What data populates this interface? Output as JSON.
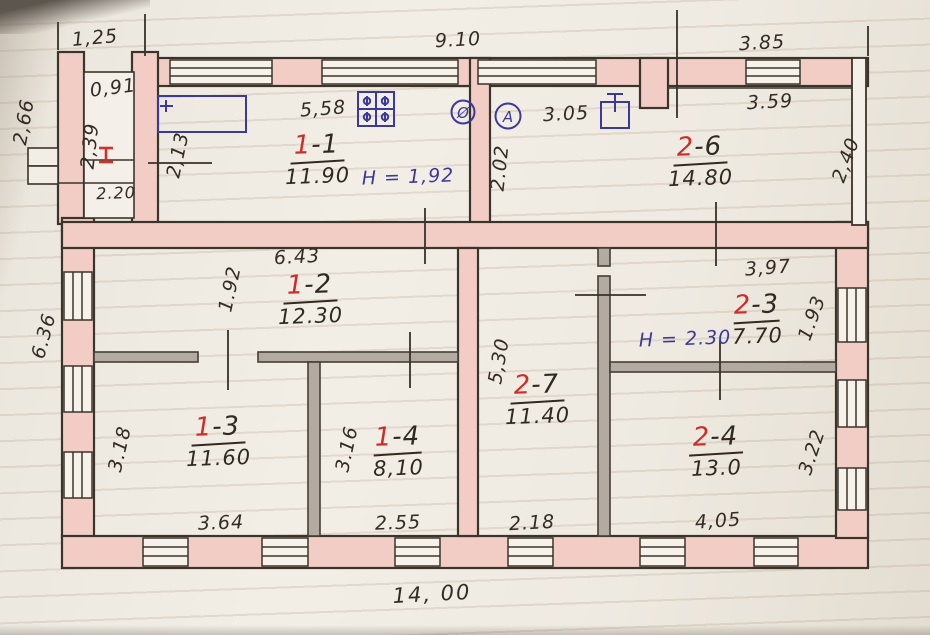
{
  "document": {
    "type": "hand-drawn floor plan on ruled paper",
    "total_width_label": "14, 00"
  },
  "dimensions_m": {
    "porch_top": "1,25",
    "top_main": "9.10",
    "top_right": "3.85",
    "porch_left": "2,66",
    "porch_inner_width": "0,91",
    "porch_inner_height": "2,39",
    "porch_bottom": "2.20",
    "hall_wall": "2,13",
    "room_1_1_top": "5,58",
    "passage_height": "2.02",
    "wash_top": "3.05",
    "room_2_6_top": "3.59",
    "room_2_6_right": "2,40",
    "left_side": "6.36",
    "room_1_2_top": "6.43",
    "room_1_2_left": "1.92",
    "room_2_3_top": "3,97",
    "room_2_3_right": "1.93",
    "room_2_7_left": "5,30",
    "room_1_3_left": "3.18",
    "room_1_4_left": "3.16",
    "room_2_4_right": "3.22",
    "room_1_3_bottom": "3.64",
    "room_1_4_bottom": "2.55",
    "room_2_7_bottom": "2.18",
    "room_2_4_bottom": "4,05",
    "total_bottom": "14, 00"
  },
  "rooms": {
    "r11": {
      "num": "1",
      "rest": "-1",
      "area": "11.90"
    },
    "r26": {
      "num": "2",
      "rest": "-6",
      "area": "14.80"
    },
    "r12": {
      "num": "1",
      "rest": "-2",
      "area": "12.30"
    },
    "r23": {
      "num": "2",
      "rest": "-3",
      "area": "7.70"
    },
    "r27": {
      "num": "2",
      "rest": "-7",
      "area": "11.40"
    },
    "r13": {
      "num": "1",
      "rest": "-3",
      "area": "11.60"
    },
    "r14": {
      "num": "1",
      "rest": "-4",
      "area": "8,10"
    },
    "r24": {
      "num": "2",
      "rest": "-4",
      "area": "13.0"
    }
  },
  "annotations": {
    "height_room_1_1": "H = 1,92",
    "height_room_2_3": "H = 2.30",
    "meter_a": "А",
    "meter_flue": "Ø"
  },
  "icons": [
    "gas-stove-icon",
    "boiler-icon",
    "counter-icon",
    "meter-a-icon",
    "flue-icon",
    "steel-beam-mark-icon",
    "window-hatch-icon"
  ],
  "colors": {
    "wall_fill": "#f1cdc5",
    "wall_line": "#3b342b",
    "partition_fill": "#b3aaa1",
    "ink_blue": "#3c3a99",
    "ink_red": "#cd2d27",
    "pencil": "#332c24",
    "paper": "#f2eee6"
  }
}
